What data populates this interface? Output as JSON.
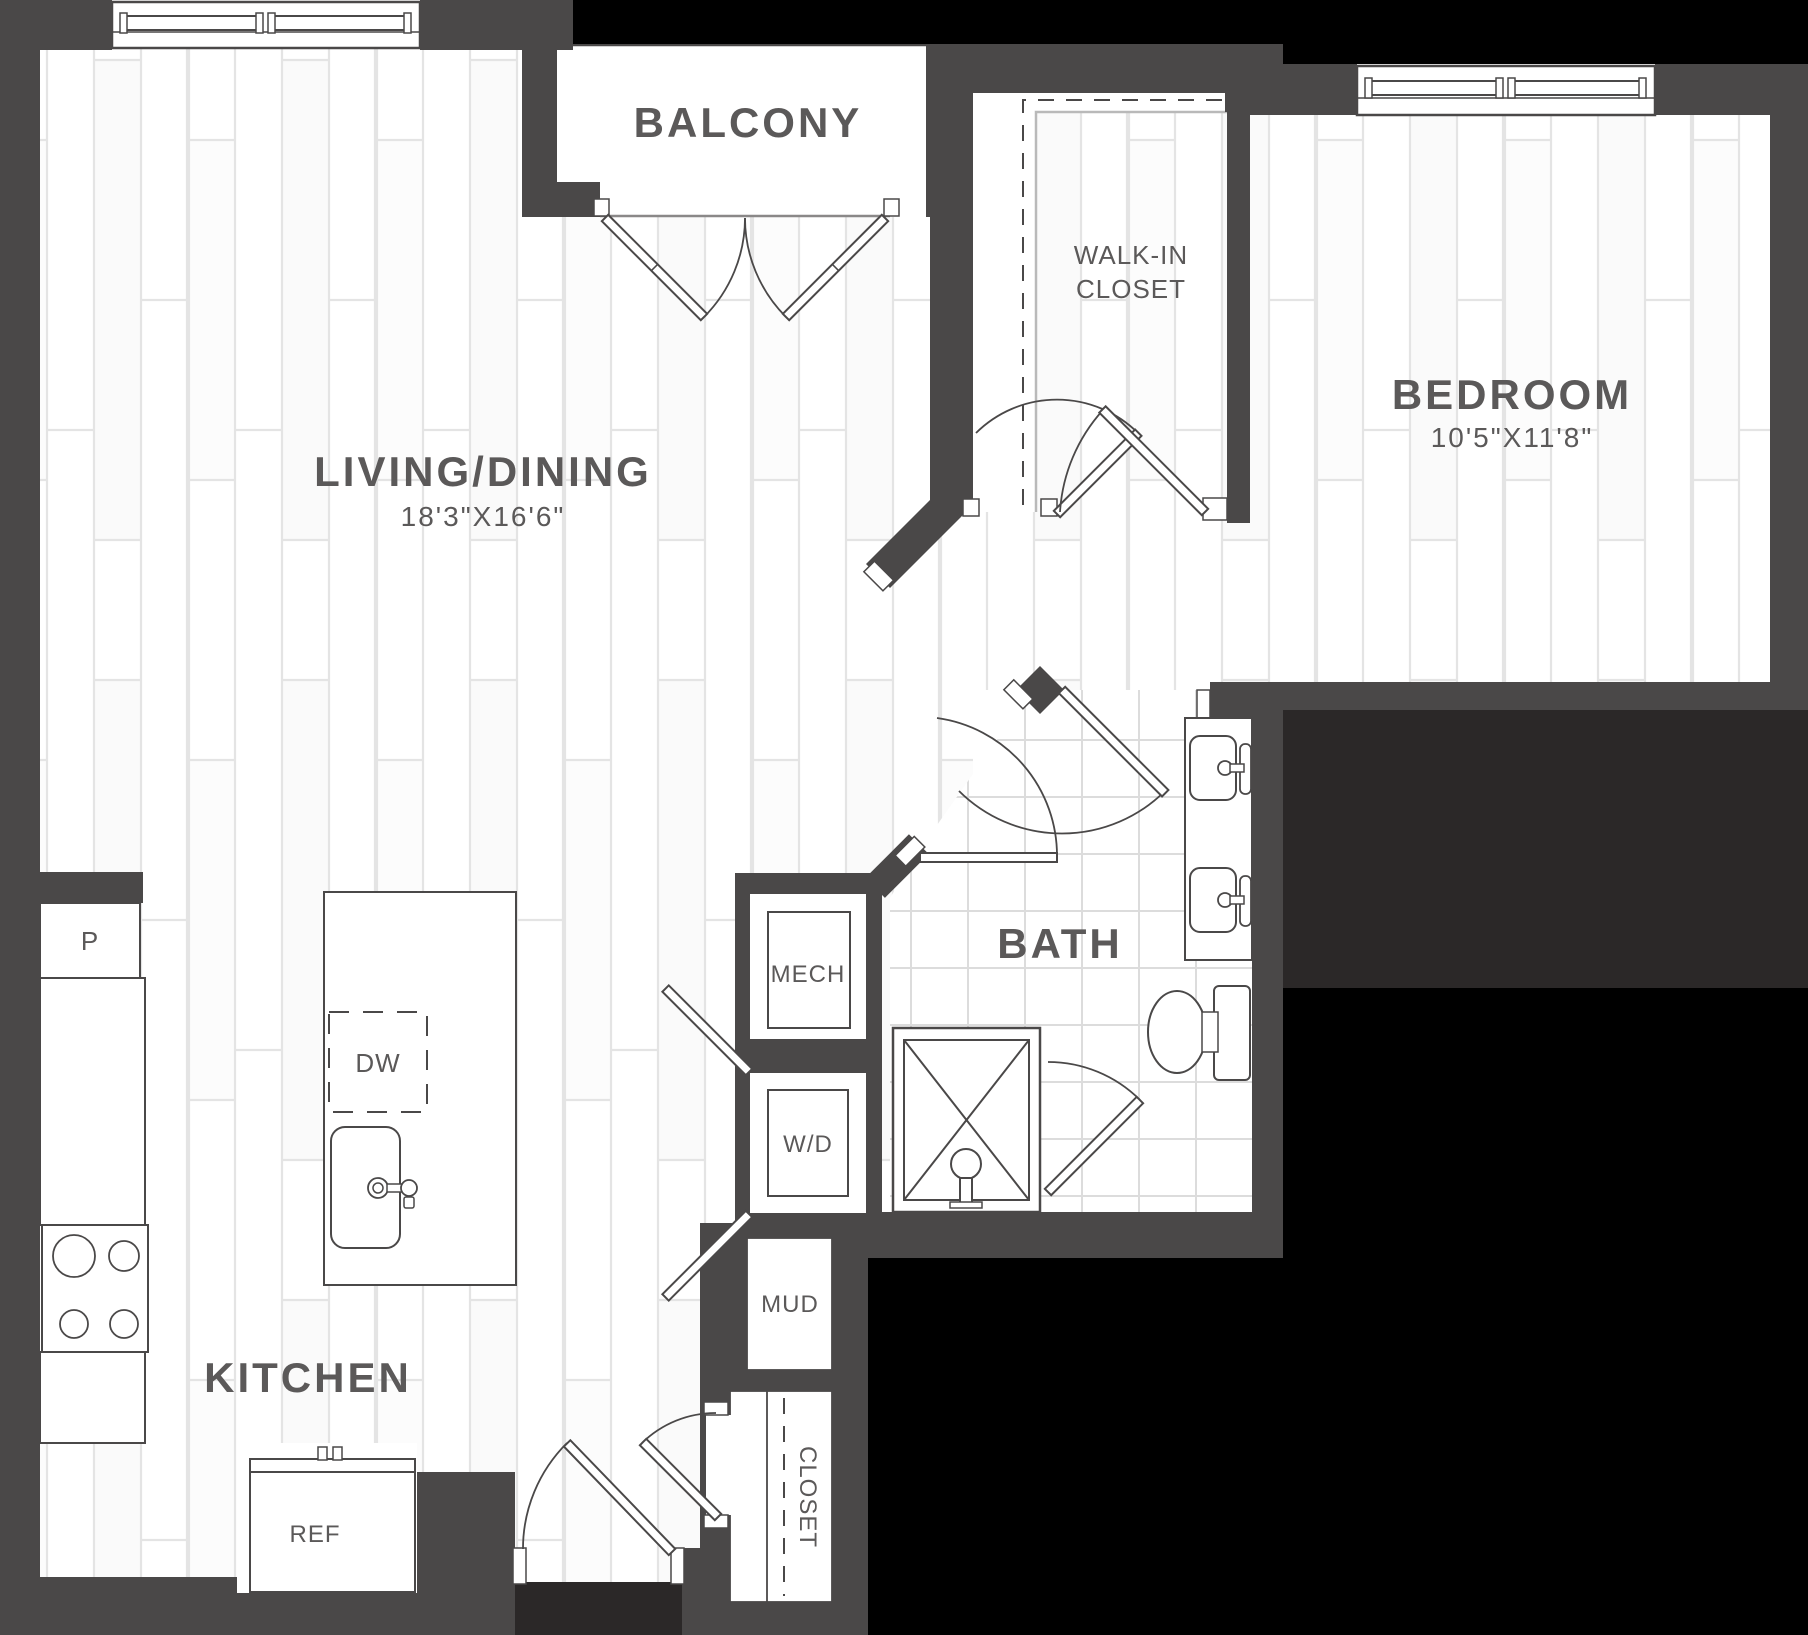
{
  "plan": {
    "balcony": {
      "label": "BALCONY"
    },
    "living_dining": {
      "label": "LIVING/DINING",
      "dimensions": "18'3\"X16'6\""
    },
    "bedroom": {
      "label": "BEDROOM",
      "dimensions": "10'5\"X11'8\""
    },
    "walk_in_closet": {
      "line1": "WALK-IN",
      "line2": "CLOSET"
    },
    "bath": {
      "label": "BATH"
    },
    "mech": {
      "label": "MECH"
    },
    "washer_dryer": {
      "label": "W/D"
    },
    "mud": {
      "label": "MUD"
    },
    "entry_closet": {
      "label": "CLOSET"
    },
    "kitchen": {
      "label": "KITCHEN"
    },
    "pantry": {
      "label": "P"
    },
    "dishwasher": {
      "label": "DW"
    },
    "refrigerator": {
      "label": "REF"
    }
  },
  "colors": {
    "wall": "#4a4848",
    "outside": "#000000",
    "outside_soft": "#2b2828",
    "label": "#5b5959",
    "fixture_line": "#4a4848",
    "plank_line": "#e4e4e4",
    "tile_line": "#dcdcdc"
  }
}
